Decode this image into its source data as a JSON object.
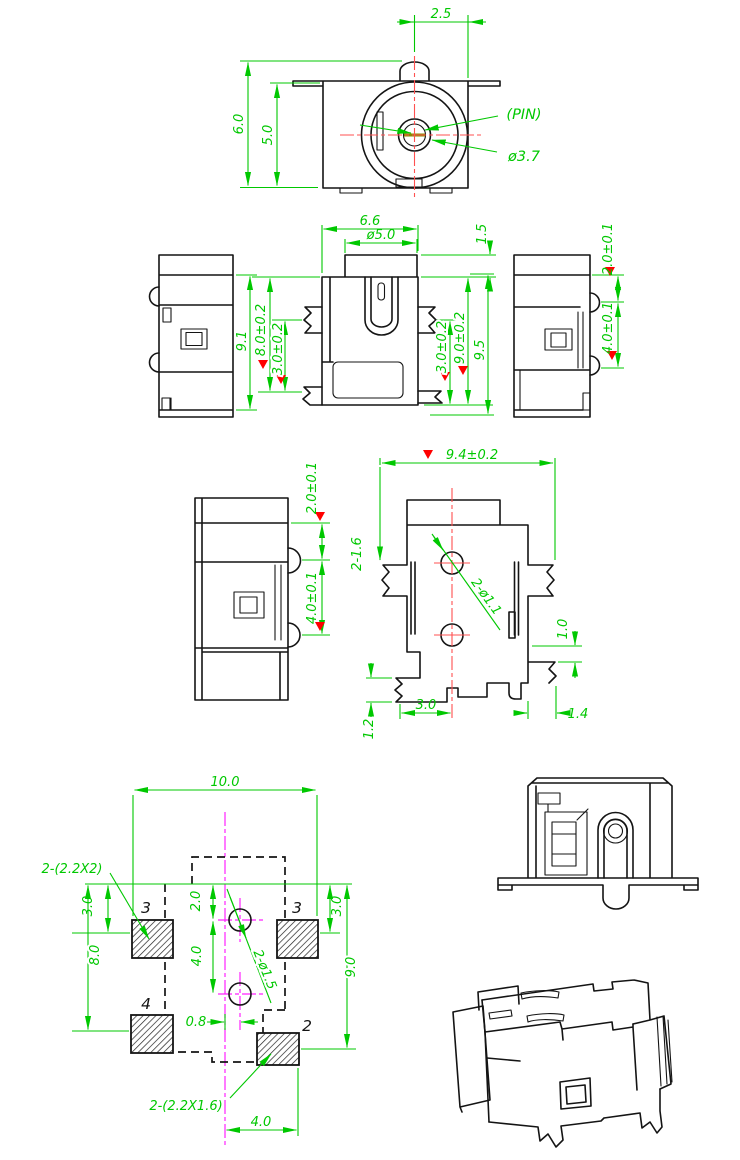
{
  "title": "DC power jack connector engineering drawing",
  "colors": {
    "dimension": "#00c800",
    "centerline_red": "#ff5050",
    "centerline_magenta": "#ff22ff",
    "outline": "#141414",
    "datum_triangle": "#ff0000",
    "pin_slot": "#8a8a00"
  },
  "front": {
    "pin_offset": "2.5",
    "height": "6.0",
    "inner_height": "5.0",
    "pin_label": "(PIN)",
    "pin_dia": "ø3.7"
  },
  "row2": {
    "side_height": "9.1",
    "width": "6.6",
    "barrel_dia": "ø5.0",
    "cap_height": "1.5",
    "body_height": "8.0±0.2",
    "tab_left": "3.0±0.2",
    "tab_right": "3.0±0.2",
    "body_right": "9.0±0.2",
    "overall": "9.5",
    "pin_top": "2.0±0.1",
    "pin_pitch": "4.0±0.1"
  },
  "row3": {
    "pin_top": "2.0±0.1",
    "pin_pitch": "4.0±0.1",
    "width": "9.4±0.2",
    "slots": "2-1.6",
    "holes": "2-ø1.1",
    "step": "1.0",
    "foot_height": "1.2",
    "foot_offset": "3.0",
    "foot_right": "1.4"
  },
  "pcb": {
    "width": "10.0",
    "note_top": "2-(2.2X2)",
    "note_bottom": "2-(2.2X1.6)",
    "holes": "2-ø1.5",
    "left_top": "3.0",
    "left_height": "8.0",
    "center_top": "2.0",
    "center_pitch": "4.0",
    "hole_offset": "0.8",
    "right_top": "3.0",
    "right_height": "9.0",
    "bottom_width": "4.0",
    "pads": [
      "3",
      "3",
      "4",
      "2"
    ]
  }
}
